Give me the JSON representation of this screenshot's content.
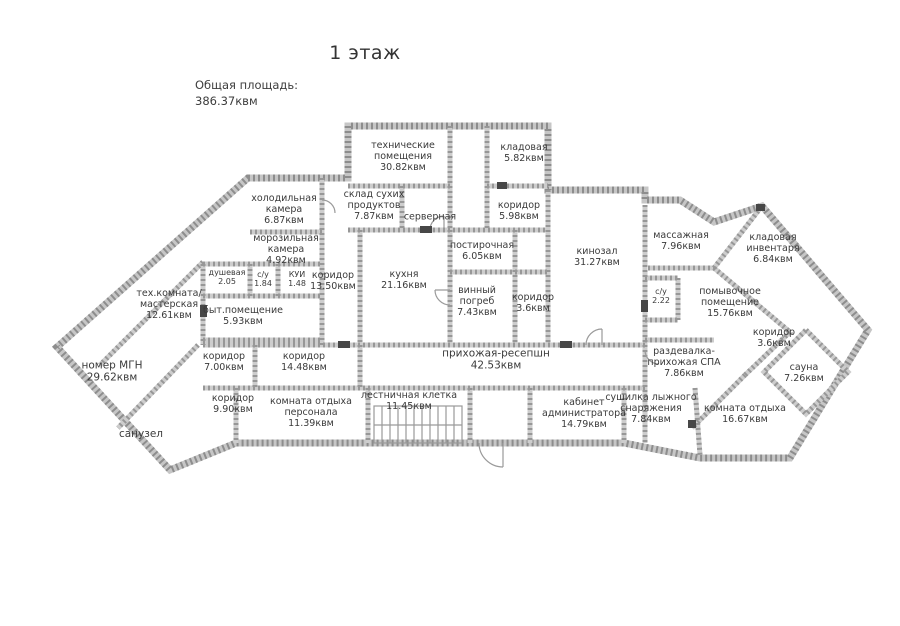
{
  "title": "1 этаж",
  "total_area": {
    "label": "Общая площадь:",
    "value": "386.37квм"
  },
  "rooms": [
    {
      "name": "технические помещения",
      "area": "30.82квм"
    },
    {
      "name": "кладовая",
      "area": "5.82квм"
    },
    {
      "name": "склад сухих продуктов",
      "area": "7.87квм"
    },
    {
      "name": "серверная",
      "area": ""
    },
    {
      "name": "коридор",
      "area": "5.98квм"
    },
    {
      "name": "холодильная камера",
      "area": "6.87квм"
    },
    {
      "name": "морозильная камера",
      "area": "4.92квм"
    },
    {
      "name": "душевая",
      "area": "2.05"
    },
    {
      "name": "с/у",
      "area": "1.84"
    },
    {
      "name": "КУИ",
      "area": "1.48"
    },
    {
      "name": "коридор",
      "area": "13.50квм"
    },
    {
      "name": "кухня",
      "area": "21.16квм"
    },
    {
      "name": "постирочная",
      "area": "6.05квм"
    },
    {
      "name": "винный погреб",
      "area": "7.43квм"
    },
    {
      "name": "коридор",
      "area": "3.6квм"
    },
    {
      "name": "кинозал",
      "area": "31.27квм"
    },
    {
      "name": "тех.комната/ мастерская",
      "area": "12.61квм"
    },
    {
      "name": "быт.помещение",
      "area": "5.93квм"
    },
    {
      "name": "номер МГН",
      "area": "29.62квм"
    },
    {
      "name": "санузел",
      "area": ""
    },
    {
      "name": "коридор",
      "area": "7.00квм"
    },
    {
      "name": "коридор",
      "area": "14.48квм"
    },
    {
      "name": "коридор",
      "area": "9.90квм"
    },
    {
      "name": "комната отдыха персонала",
      "area": "11.39квм"
    },
    {
      "name": "лестничная клетка",
      "area": "11.45квм"
    },
    {
      "name": "прихожая-ресепшн",
      "area": "42.53квм"
    },
    {
      "name": "кабинет администратора",
      "area": "14.79квм"
    },
    {
      "name": "сушилка лыжного снаряжения",
      "area": "7.84квм"
    },
    {
      "name": "раздевалка- прихожая СПА",
      "area": "7.86квм"
    },
    {
      "name": "массажная",
      "area": "7.96квм"
    },
    {
      "name": "кладовая инвентаря",
      "area": "6.84квм"
    },
    {
      "name": "с/у",
      "area": "2.22"
    },
    {
      "name": "помывочное помещение",
      "area": "15.76квм"
    },
    {
      "name": "коридор",
      "area": "3.6квм"
    },
    {
      "name": "сауна",
      "area": "7.26квм"
    },
    {
      "name": "комната отдыха",
      "area": "16.67квм"
    }
  ]
}
